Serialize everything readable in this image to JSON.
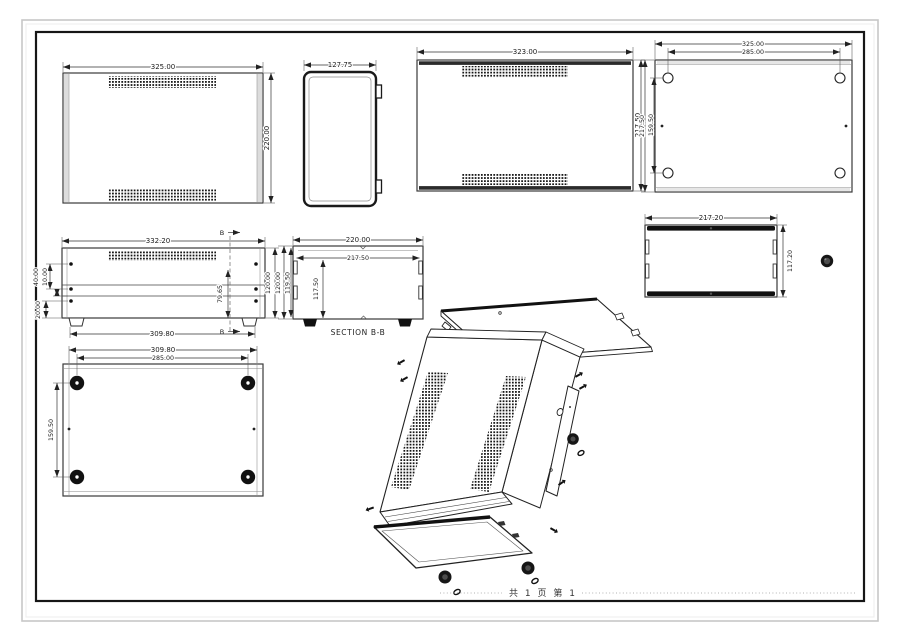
{
  "sheet": {
    "footer_text": "共 1 页  第 1"
  },
  "views": {
    "front": {
      "width": "325.00",
      "height": "220.00"
    },
    "side": {
      "width": "127.75"
    },
    "top": {
      "width": "323.00",
      "height": "217.50"
    },
    "mounting": {
      "outer_width": "325.00",
      "hole_spacing_x": "285.00",
      "outer_height": "217.50",
      "hole_spacing_y": "159.50"
    },
    "front_panel": {
      "top_width": "332.20",
      "bottom_width": "309.80",
      "offset_a": "40.00",
      "offset_b": "10.00",
      "offset_c": "20.00",
      "inner_height": "79.65",
      "height": "120.00",
      "section_marker": "B"
    },
    "section": {
      "outer_width": "220.00",
      "inner_width": "217.50",
      "inner_height": "117.50",
      "height": "120.00",
      "height_inner": "119.50",
      "title": "SECTION B-B"
    },
    "rear": {
      "width": "217.20",
      "height": "117.20"
    },
    "bottom": {
      "width": "309.80",
      "feet_spacing_x": "285.00",
      "feet_spacing_y": "159.50"
    }
  }
}
